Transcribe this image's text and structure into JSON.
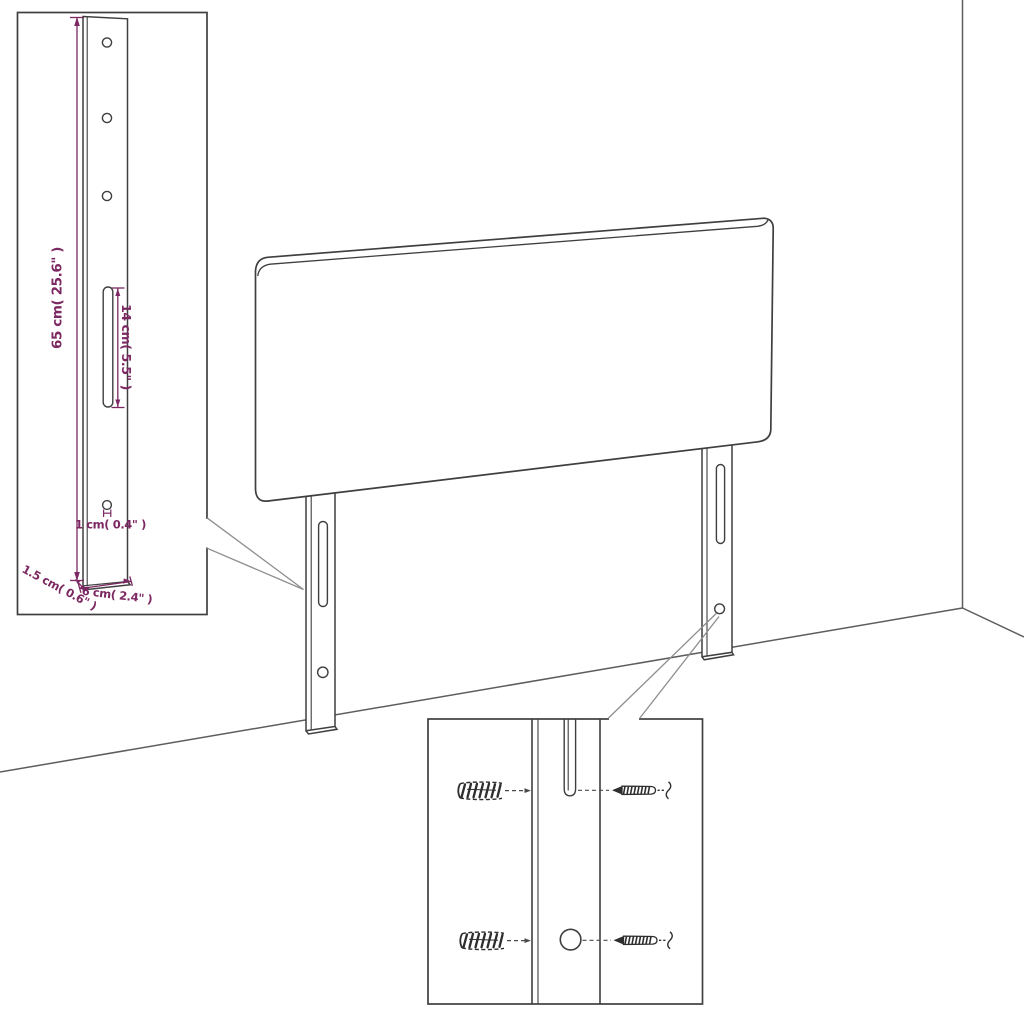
{
  "page": {
    "background": "#ffffff",
    "kind": "furniture assembly dimension diagram",
    "subject": "upholstered headboard with two mounting legs"
  },
  "colors": {
    "outline": "#3f3f3f",
    "room_line": "#5d5d5d",
    "leader_line": "#8e8e8e",
    "dimension_accent": "#7c2862"
  },
  "main_drawing": {
    "headboard_panel": "headboard panel (rounded rolled top edge)",
    "left_leg": "left mounting leg with slot and round hole",
    "right_leg": "right mounting leg with slot and round hole",
    "room": "wall corner and floor lines"
  },
  "leg_detail_inset": {
    "hole_count_top": 3,
    "dim_height": "65 cm( 25.6\" )",
    "dim_slot_length": "14 cm( 5.5\" )",
    "dim_hole_diameter": "1 cm( 0.4\" )",
    "dim_leg_thickness": "1.5 cm( 0.6\" )",
    "dim_leg_width": "6 cm( 2.4\" )"
  },
  "mounting_detail_inset": {
    "hardware": [
      "wall anchor (top)",
      "screw (top)",
      "wall anchor (bottom)",
      "screw (bottom)"
    ],
    "features": [
      "leg slot (top row)",
      "leg round hole (bottom row)"
    ]
  }
}
